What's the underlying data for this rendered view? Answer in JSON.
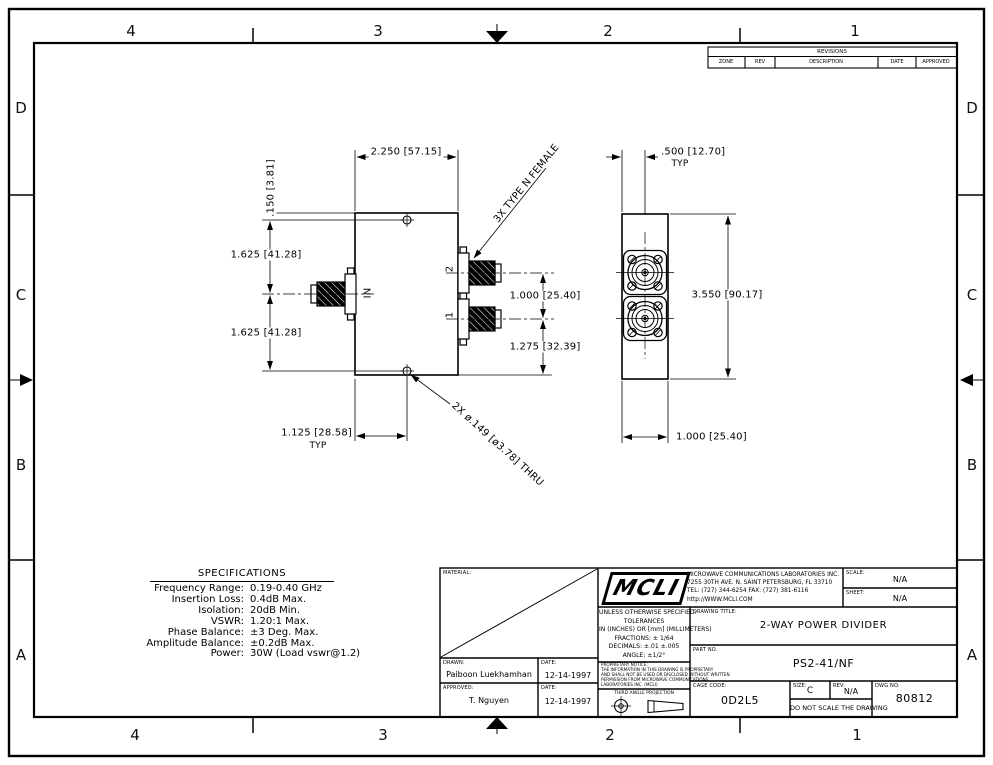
{
  "zones": {
    "top": [
      "4",
      "3",
      "2",
      "1"
    ],
    "bottom": [
      "4",
      "3",
      "2",
      "1"
    ],
    "left": [
      "D",
      "C",
      "B",
      "A"
    ],
    "right": [
      "D",
      "C",
      "B",
      "A"
    ]
  },
  "revisions": {
    "title": "REVISIONS",
    "columns": [
      "ZONE",
      "REV",
      "DESCRIPTION",
      "DATE",
      "APPROVED"
    ]
  },
  "specs": {
    "title": "SPECIFICATIONS",
    "rows": [
      {
        "label": "Frequency Range:",
        "value": "0.19-0.40 GHz"
      },
      {
        "label": "Insertion Loss:",
        "value": "0.4dB Max."
      },
      {
        "label": "Isolation:",
        "value": "20dB Min."
      },
      {
        "label": "VSWR:",
        "value": "1.20:1 Max."
      },
      {
        "label": "Phase Balance:",
        "value": "±3 Deg. Max."
      },
      {
        "label": "Amplitude Balance:",
        "value": "±0.2dB Max."
      },
      {
        "label": "Power:",
        "value": "30W (Load vswr@1.2)"
      }
    ]
  },
  "views": {
    "front": {
      "dims": {
        "width": "2.250 [57.15]",
        "hole_offset": ".150 [3.81]",
        "upper": "1.625 [41.28]",
        "lower": "1.625 [41.28]",
        "port_spacing": "1.000 [25.40]",
        "port1_bottom": "1.275 [32.39]",
        "hole_x": "1.125 [28.58]",
        "hole_x_typ": "TYP",
        "hole_note": "2X ø.149 [ø3.78] THRU",
        "connector_note": "3X TYPE N FEMALE"
      },
      "labels": {
        "input": "IN",
        "port2": "2",
        "port1": "1"
      }
    },
    "side": {
      "dims": {
        "edge": ".500 [12.70]",
        "edge_typ": "TYP",
        "height": "3.550 [90.17]",
        "width": "1.000 [25.40]"
      }
    }
  },
  "title_block": {
    "material_label": "MATERIAL:",
    "drawn_label": "DRAWN:",
    "drawn": "Paiboon Luekhamhan",
    "drawn_date_label": "DATE:",
    "drawn_date": "12-14-1997",
    "approved_label": "APPROVED:",
    "approved": "T. Nguyen",
    "approved_date_label": "DATE:",
    "approved_date": "12-14-1997",
    "logo": "MCLI",
    "company_lines": [
      "MICROWAVE COMMUNICATIONS LABORATORIES INC.",
      "7255 30TH AVE. N. SAINT PETERSBURG, FL 33710",
      "TEL: (727) 344-6254   FAX: (727) 381-6116",
      "http://WWW.MCLI.COM"
    ],
    "tolerance_lines": [
      "UNLESS OTHERWISE SPECIFIED:",
      "TOLERANCES",
      "IN (INCHES) OR [mm] (MILLIMETERS)",
      "FRACTIONS: ± 1/64",
      "DECIMALS: ±.01  ±.005",
      "ANGLE: ±1/2°"
    ],
    "proprietary_lines": [
      "PROPRIETARY NOTICE:",
      "THE INFORMATION IN THIS DRAWING IS PROPRIETARY",
      "AND SHALL NOT BE USED OR DISCLOSED WITHOUT WRITTEN",
      "PERMISSION FROM MICROWAVE COMMUNICATIONS",
      "LABORATORIES INC. (MCLI)"
    ],
    "projection_label": "THIRD ANGLE PROJECTION",
    "scale_label": "SCALE:",
    "scale": "N/A",
    "sheet_label": "SHEET:",
    "sheet": "N/A",
    "title_label": "DRAWING TITLE:",
    "title": "2-WAY POWER DIVIDER",
    "part_no_label": "PART NO.",
    "part_no": "PS2-41/NF",
    "cage_code_label": "CAGE CODE:",
    "cage_code": "0D2L5",
    "size_label": "SIZE:",
    "size": "C",
    "rev_label": "REV:",
    "rev": "N/A",
    "dwg_no_label": "DWG NO.",
    "dwg_no": "80812",
    "no_scale_note": "DO NOT SCALE THE DRAWING"
  }
}
